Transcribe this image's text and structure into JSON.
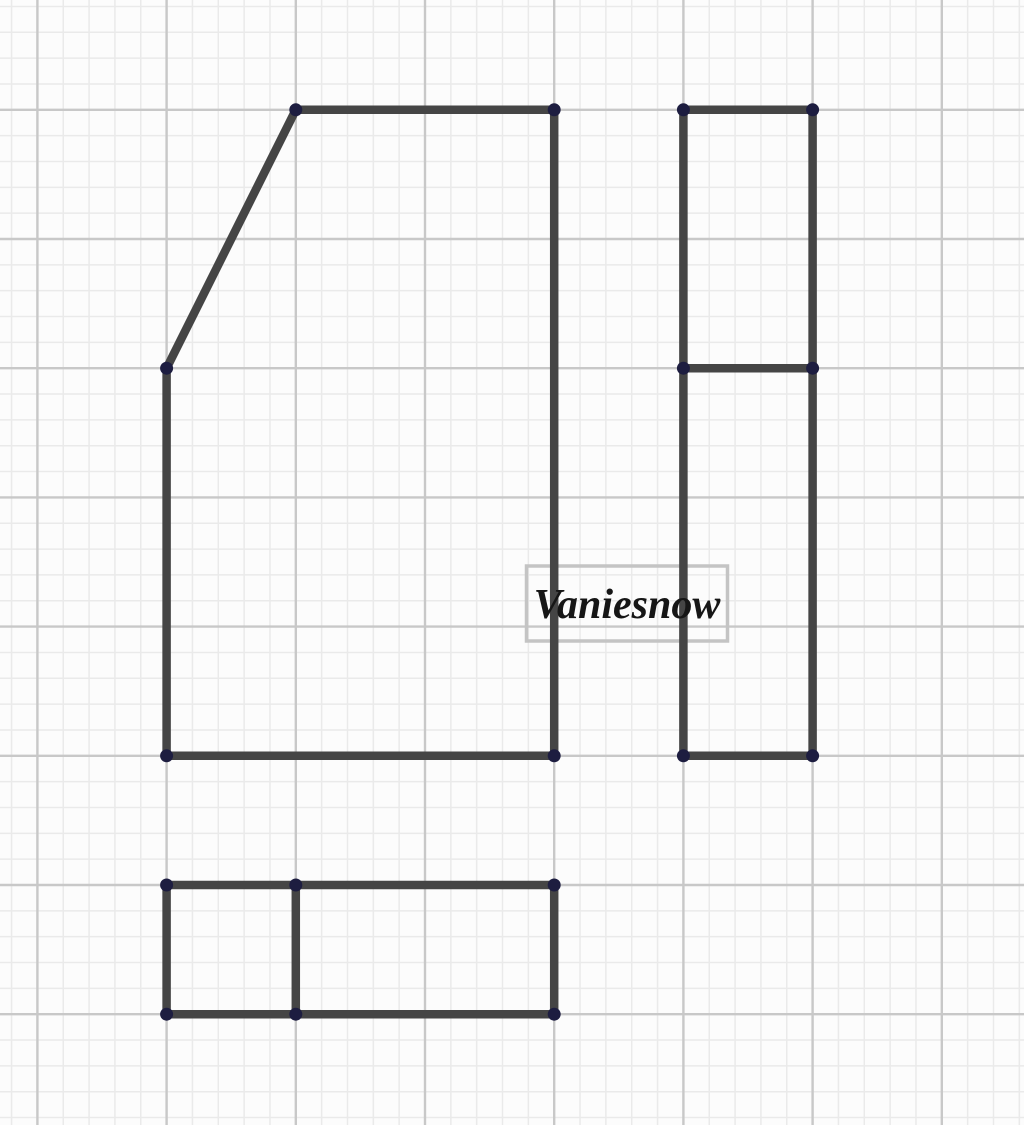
{
  "canvas": {
    "width": 1024,
    "height": 1125,
    "background_color": "#fcfcfc",
    "grid": {
      "minor_spacing": 25.84,
      "majors_every": 5,
      "offset_x": 37.4,
      "offset_y": 109.8,
      "minor_color": "#eaeaea",
      "major_color": "#c8c8c8",
      "minor_width": 1.5,
      "major_width": 2.4
    }
  },
  "style": {
    "segment_color": "#454545",
    "segment_width": 8.5,
    "point_color": "#1d1d40",
    "point_radius": 6.5
  },
  "shapes": [
    {
      "name": "front-view-outline",
      "closed": true,
      "points": [
        [
          295.8,
          109.8
        ],
        [
          554.2,
          109.8
        ],
        [
          554.2,
          755.8
        ],
        [
          166.6,
          755.8
        ],
        [
          166.6,
          368.2
        ]
      ]
    },
    {
      "name": "side-view-outline",
      "closed": true,
      "points": [
        [
          683.4,
          109.8
        ],
        [
          812.6,
          109.8
        ],
        [
          812.6,
          755.8
        ],
        [
          683.4,
          755.8
        ]
      ]
    },
    {
      "name": "side-view-divider",
      "closed": false,
      "points": [
        [
          683.4,
          368.2
        ],
        [
          812.6,
          368.2
        ]
      ]
    },
    {
      "name": "top-view-outline",
      "closed": true,
      "points": [
        [
          166.6,
          885.0
        ],
        [
          554.2,
          885.0
        ],
        [
          554.2,
          1014.2
        ],
        [
          166.6,
          1014.2
        ]
      ]
    },
    {
      "name": "top-view-divider",
      "closed": false,
      "points": [
        [
          295.8,
          885.0
        ],
        [
          295.8,
          1014.2
        ]
      ]
    }
  ],
  "vertices": [
    [
      295.8,
      109.8
    ],
    [
      554.2,
      109.8
    ],
    [
      166.6,
      368.2
    ],
    [
      166.6,
      755.8
    ],
    [
      554.2,
      755.8
    ],
    [
      683.4,
      109.8
    ],
    [
      812.6,
      109.8
    ],
    [
      683.4,
      368.2
    ],
    [
      812.6,
      368.2
    ],
    [
      683.4,
      755.8
    ],
    [
      812.6,
      755.8
    ],
    [
      166.6,
      885.0
    ],
    [
      295.8,
      885.0
    ],
    [
      554.2,
      885.0
    ],
    [
      166.6,
      1014.2
    ],
    [
      295.8,
      1014.2
    ],
    [
      554.2,
      1014.2
    ]
  ],
  "label": {
    "text": "Vaniesnow",
    "box_x": 526.5,
    "box_y": 566,
    "box_width": 201,
    "box_height": 75,
    "border_color": "#c4c4c4",
    "border_width": 3.5,
    "text_color": "#161616",
    "font_size": 42
  }
}
